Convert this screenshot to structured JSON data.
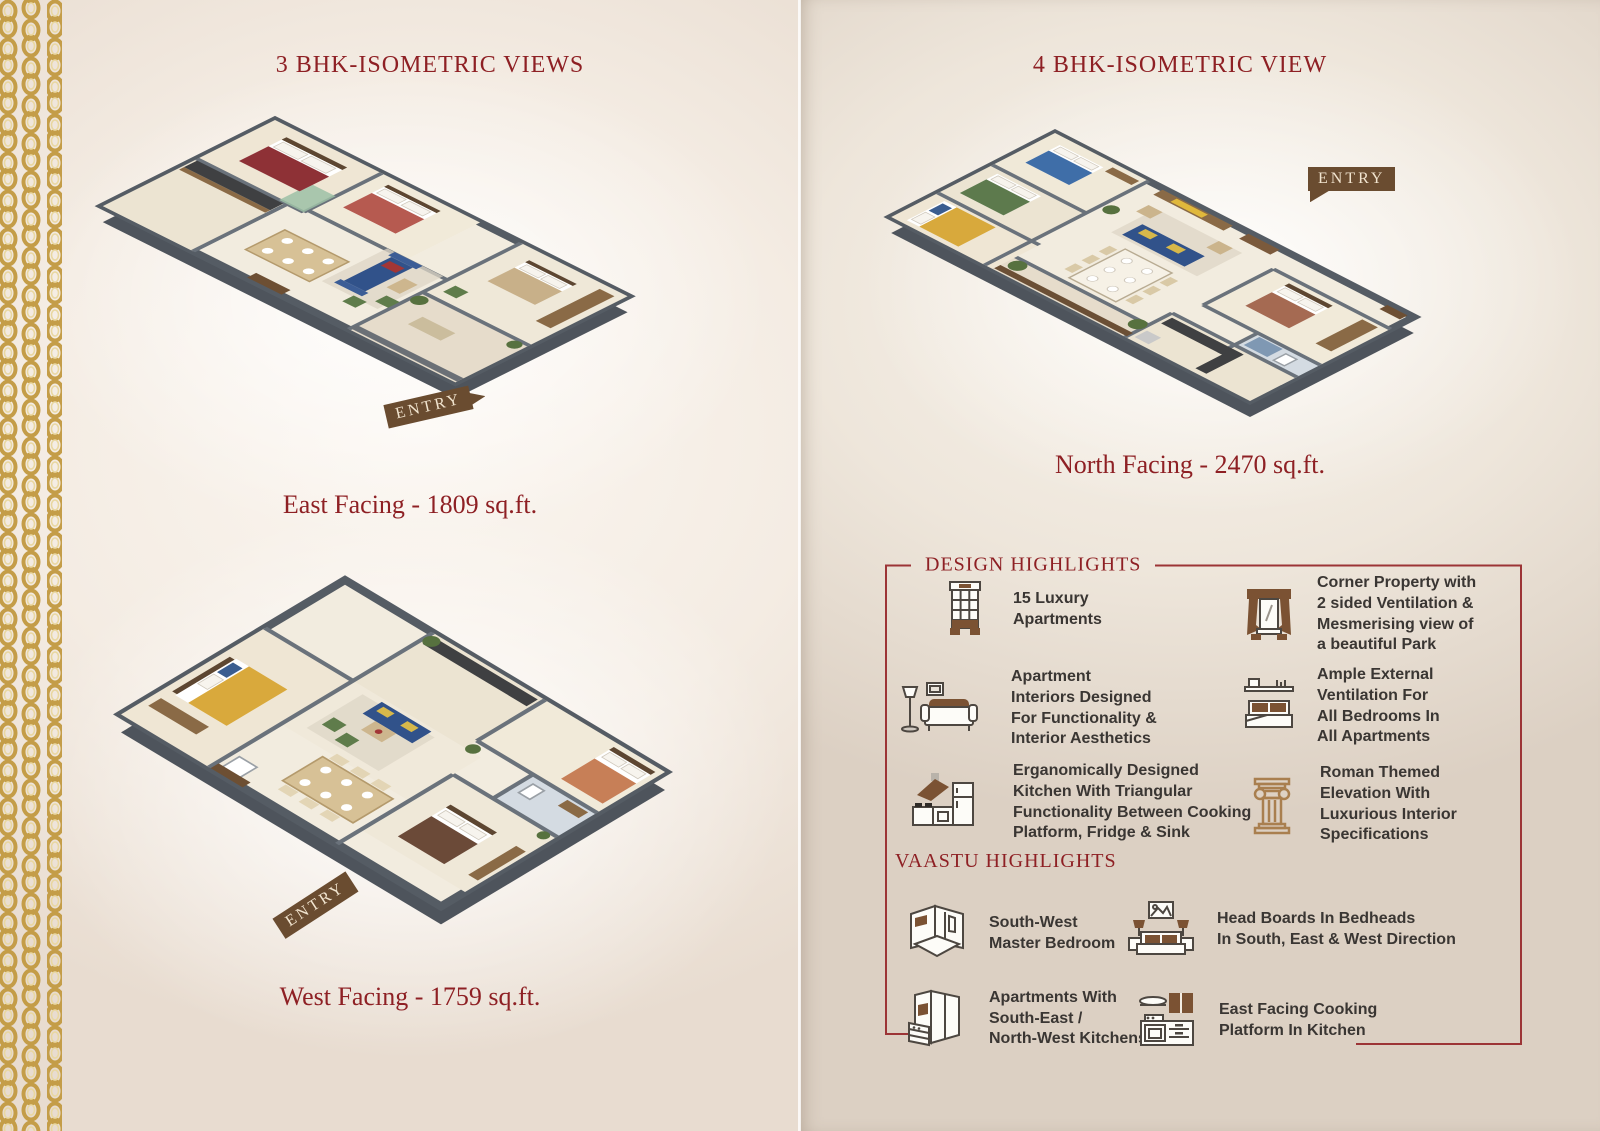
{
  "left": {
    "title": "3 BHK-ISOMETRIC VIEWS",
    "plans": [
      {
        "caption": "East Facing - 1809 sq.ft.",
        "entry_label": "ENTRY"
      },
      {
        "caption": "West Facing - 1759 sq.ft.",
        "entry_label": "ENTRY"
      }
    ]
  },
  "right": {
    "title": "4 BHK-ISOMETRIC VIEW",
    "plan": {
      "caption": "North Facing - 2470 sq.ft.",
      "entry_label": "ENTRY"
    },
    "design_highlights": {
      "heading": "DESIGN HIGHLIGHTS",
      "items": [
        {
          "icon": "apartment-building-icon",
          "text": "15 Luxury\nApartments"
        },
        {
          "icon": "window-curtain-icon",
          "text": "Corner Property with\n2 sided Ventilation &\nMesmerising view of\na beautiful Park"
        },
        {
          "icon": "sofa-lamp-icon",
          "text": "Apartment\nInteriors Designed\nFor Functionality &\nInterior Aesthetics"
        },
        {
          "icon": "bed-shelf-icon",
          "text": "Ample External\nVentilation For\nAll Bedrooms In\nAll Apartments"
        },
        {
          "icon": "kitchen-hood-fridge-icon",
          "text": "Erganomically Designed\nKitchen With Triangular\nFunctionality Between Cooking\nPlatform, Fridge & Sink"
        },
        {
          "icon": "roman-column-icon",
          "text": "Roman Themed\nElevation With\nLuxurious Interior\nSpecifications"
        }
      ]
    },
    "vaastu_highlights": {
      "heading": "VAASTU HIGHLIGHTS",
      "items": [
        {
          "icon": "master-bedroom-icon",
          "text": "South-West\nMaster Bedroom"
        },
        {
          "icon": "bedheads-icon",
          "text": "Head Boards In Bedheads\nIn South, East & West Direction"
        },
        {
          "icon": "corner-kitchen-icon",
          "text": "Apartments With\nSouth-East /\nNorth-West Kitchens"
        },
        {
          "icon": "cooking-platform-icon",
          "text": "East Facing Cooking\nPlatform In Kitchen"
        }
      ]
    }
  },
  "colors": {
    "maroon": "#8e2024",
    "frame_line": "#9c3436",
    "gold": "#c49d48",
    "icon_brown": "#7b5233",
    "body_text": "#3a3633",
    "entry_banner": "#6a4c30"
  }
}
